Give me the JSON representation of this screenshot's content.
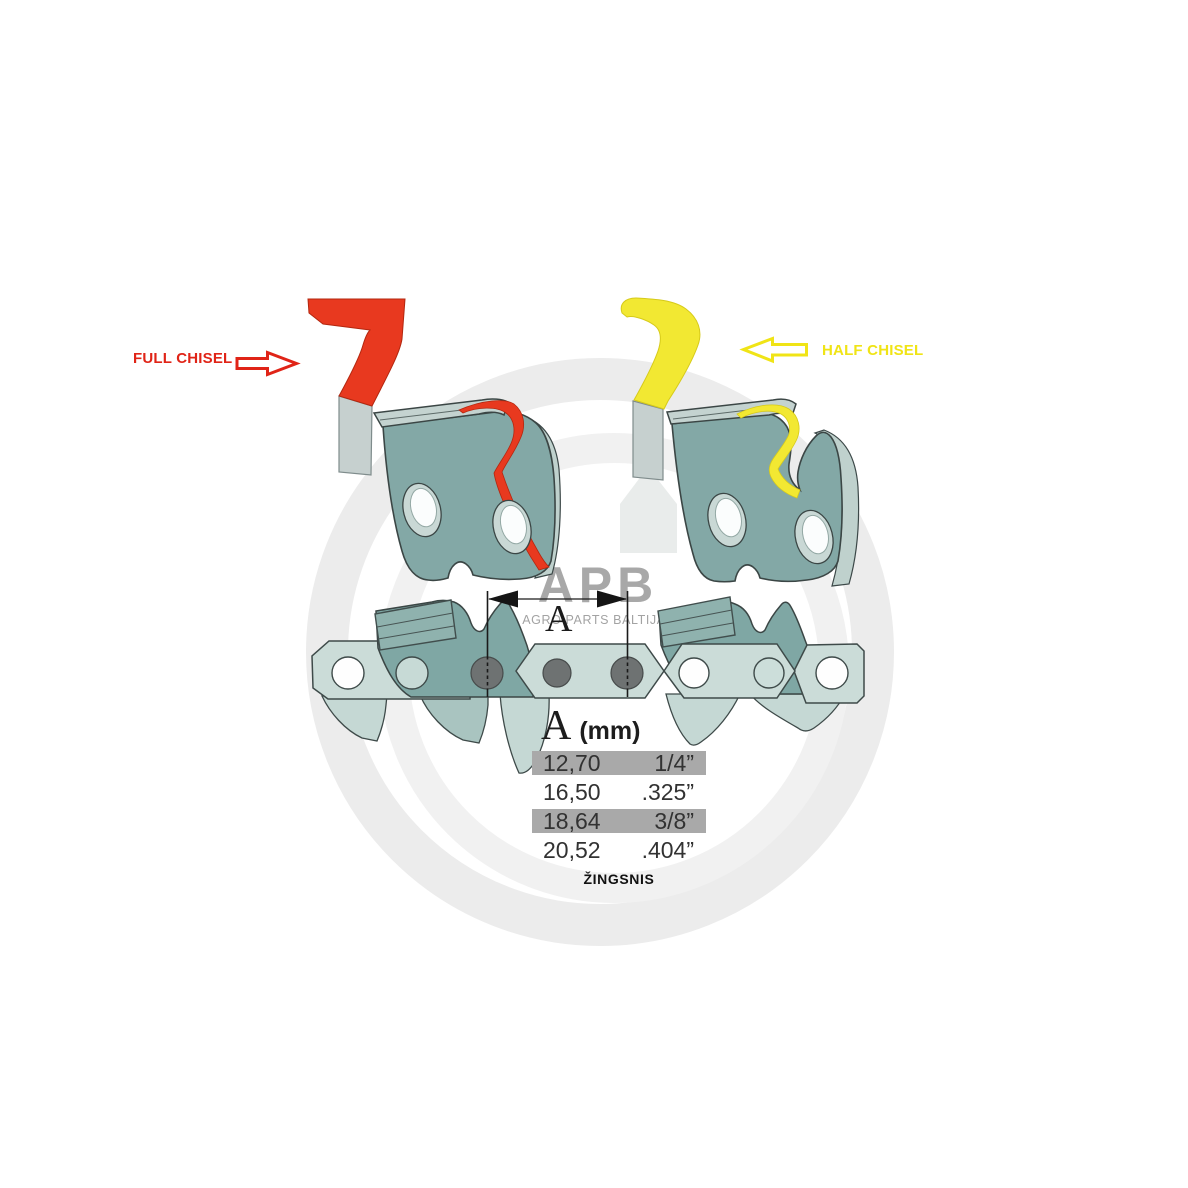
{
  "labels": {
    "full_chisel": "FULL CHISEL",
    "half_chisel": "HALF CHISEL"
  },
  "watermark": {
    "logo": "APB",
    "subtitle": "AGRO PARTS BALTIJA"
  },
  "dimension": {
    "label": "A"
  },
  "pitch_table": {
    "header": {
      "symbol": "A",
      "unit": "(mm)"
    },
    "rows": [
      {
        "mm": "12,70",
        "inch": "1/4”",
        "highlighted": true
      },
      {
        "mm": "16,50",
        "inch": ".325”",
        "highlighted": false
      },
      {
        "mm": "18,64",
        "inch": "3/8”",
        "highlighted": true
      },
      {
        "mm": "20,52",
        "inch": ".404”",
        "highlighted": false
      }
    ],
    "footer": "ŽINGSNIS"
  },
  "colors": {
    "full_chisel_red": "#e8391f",
    "half_chisel_yellow": "#f2e832",
    "label_red": "#e02417",
    "label_yellow": "#f0e416",
    "cutter_teal": "#83a8a6",
    "chain_strap": "#cbdcd8",
    "row_highlight": "#a9a9a9",
    "watermark_gray": "#9a9a9a"
  }
}
